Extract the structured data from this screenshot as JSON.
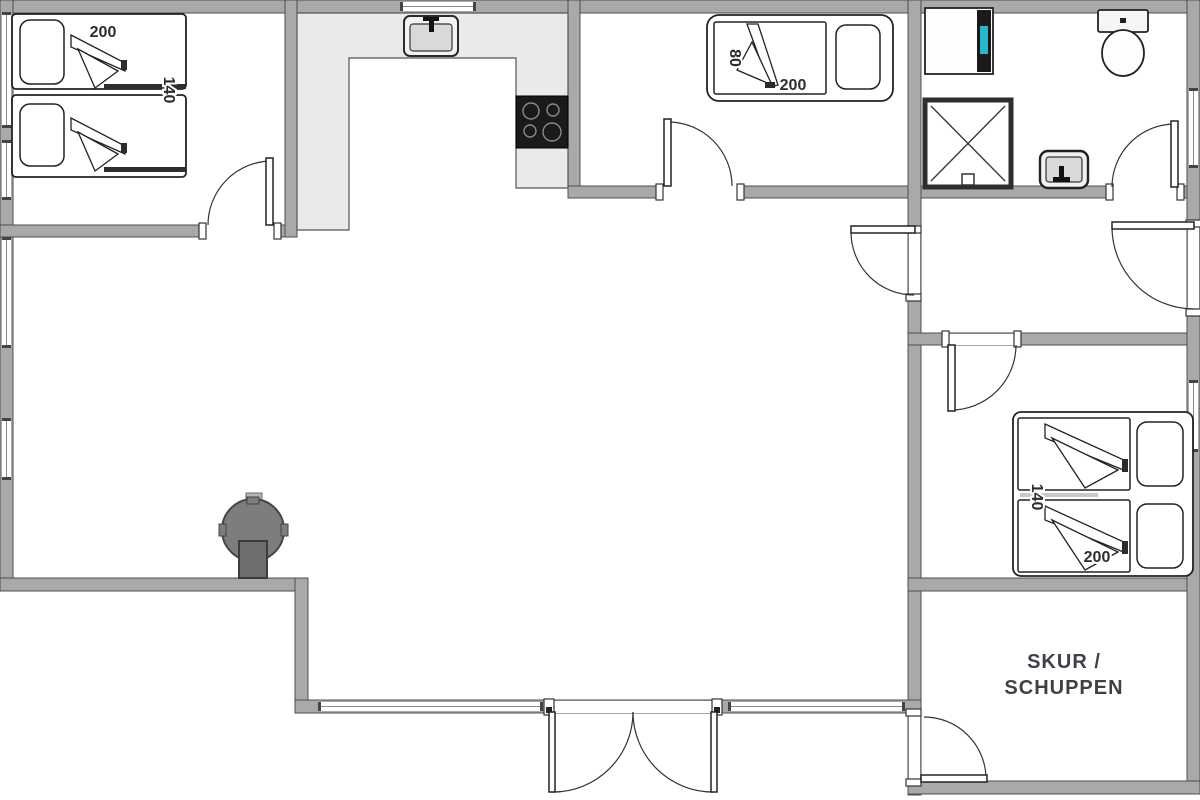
{
  "plan": {
    "type": "floor-plan"
  },
  "colors": {
    "wall_fill": "#a9a9a9",
    "wall_stroke": "#4f4f4f",
    "counter_fill": "#eaeaea",
    "cooktop_fill": "#1a1a1a",
    "stove_fill": "#7d7d7d",
    "flue_fill": "#6e6e6e",
    "washer_accent": "#2ab5c8",
    "basin_fill": "#d9d9d9",
    "dim_text": "#2d2d31",
    "room_text": "#3d4249"
  },
  "beds": [
    {
      "room": "bedroom-top-left",
      "length": "200",
      "width": "140"
    },
    {
      "room": "bedroom-top-middle",
      "width": "80",
      "length": "200"
    },
    {
      "room": "bedroom-right",
      "width": "140",
      "length": "200"
    }
  ],
  "rooms": {
    "shed": {
      "name_line1": "SKUR /",
      "name_line2": "SCHUPPEN"
    }
  }
}
